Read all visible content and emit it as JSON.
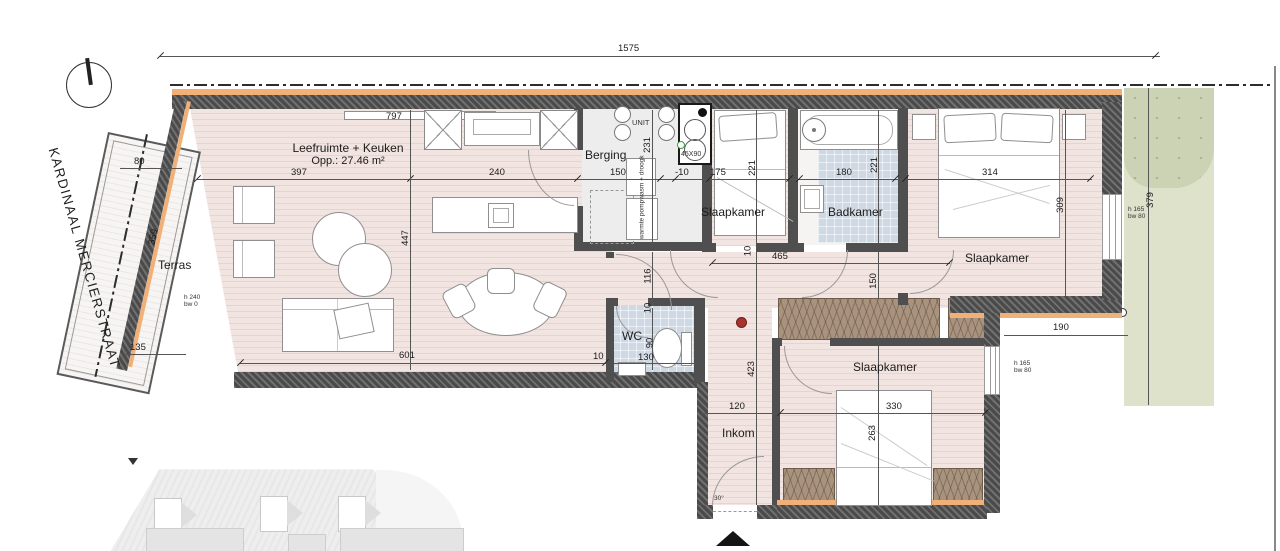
{
  "street_label": "KARDINAAL MERCIERSTRAAT",
  "rooms": {
    "terras": {
      "name": "Terras"
    },
    "living": {
      "name": "Leefruimte + Keuken",
      "area": "Opp.: 27.46 m²"
    },
    "berging": {
      "name": "Berging"
    },
    "bedroom1": {
      "name": "Slaapkamer"
    },
    "bathroom": {
      "name": "Badkamer"
    },
    "bedroom2": {
      "name": "Slaapkamer"
    },
    "wc": {
      "name": "WC"
    },
    "inkom": {
      "name": "Inkom"
    },
    "bedroom3": {
      "name": "Slaapkamer"
    }
  },
  "equipment": {
    "unit": "UNIT",
    "shaft": "45X90",
    "washer_dryer": "wasm + droogk",
    "heat_pump": "warmte pomp"
  },
  "window_tags": {
    "terras": {
      "l1": "h 240",
      "l2": "bw 0"
    },
    "bedroom2": {
      "l1": "h 165",
      "l2": "bw 80"
    },
    "bedroom3": {
      "l1": "h 165",
      "l2": "bw 80"
    }
  },
  "dimensions": {
    "total_width": "1575",
    "living_top": "797",
    "living_w": "397",
    "living_h": "447",
    "kitchen_w": "240",
    "berging_w": "150",
    "berging_h": "231",
    "joint": "-10",
    "bedroom1_w": "175",
    "bedroom1_h": "221",
    "bathroom_w": "180",
    "bathroom_h": "221",
    "bedroom2_w": "314",
    "bedroom2_h": "309",
    "garden_h": "379",
    "hall_w": "465",
    "hall_h": "116",
    "hall_off": "10",
    "hall_door": "10",
    "closet_d": "150",
    "living_bottom": "601",
    "wc_off": "10",
    "wc_h": "90",
    "wc_w": "130",
    "hall_v": "423",
    "inkom_w": "120",
    "bedroom3_w": "330",
    "bedroom3_h": "263",
    "setback": "190",
    "terras_top": "80",
    "terras_len": "359",
    "terras_bottom": "135",
    "door_angle": "30°"
  },
  "colors": {
    "wall": "#4a4a4a",
    "insulation": "#f0b078",
    "floor_wood": "#f0e1dd",
    "tile": "#cfd9e5",
    "wardrobe": "#a8937f",
    "garden": "#dee2cb",
    "garden_dotted": "#ccd3b4",
    "detector_red": "#a8322c"
  }
}
